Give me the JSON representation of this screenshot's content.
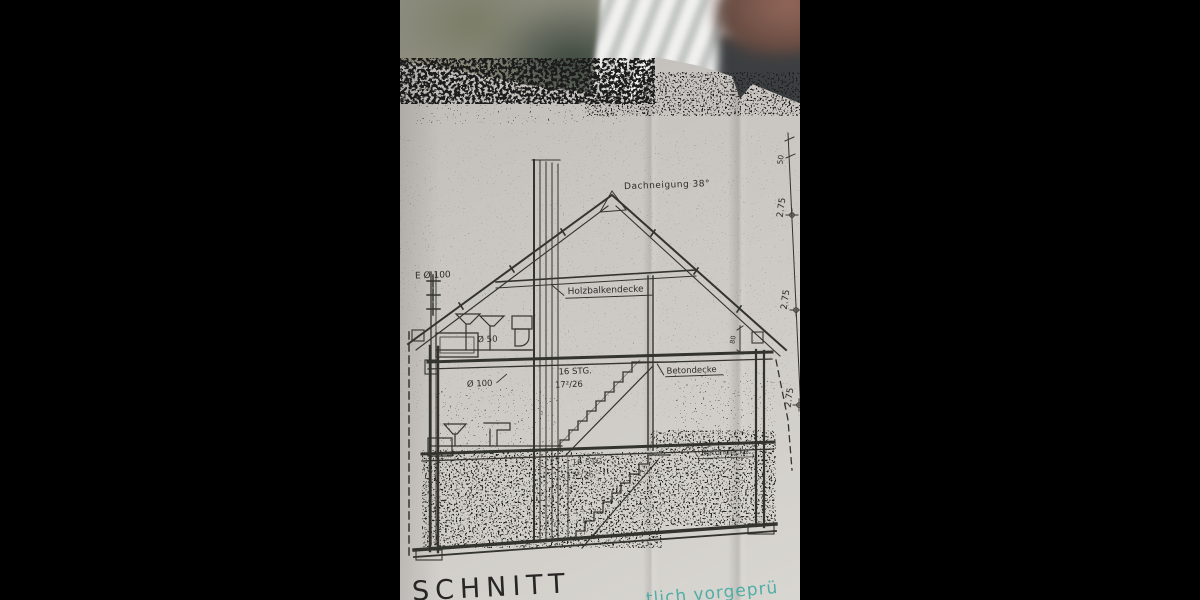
{
  "blueprint": {
    "title": "SCHNITT",
    "stamp": {
      "text": "tlich vorgeprü",
      "color": "#3aa79e"
    },
    "labels": {
      "roof_pitch": "Dachneigung  38°",
      "attic_ceiling": "Holzbalkendecke",
      "ceiling_upper": "Betondecke",
      "ceiling_lower": "Betondecke",
      "vent_stack": "E Ø 100",
      "pipe_dia_50": "Ø 50",
      "pipe_dia_100": "Ø 100",
      "stairs_upper_count": "16 STG.",
      "stairs_upper_ratio": "17²/26",
      "stairs_lower_count": "16 STG.",
      "stairs_lower_ratio": "17²/26",
      "knee_wall_height": "80"
    },
    "dimensions_right": {
      "top": "50",
      "attic": "2.75",
      "upper": "2.75",
      "lower": "2.75"
    }
  }
}
